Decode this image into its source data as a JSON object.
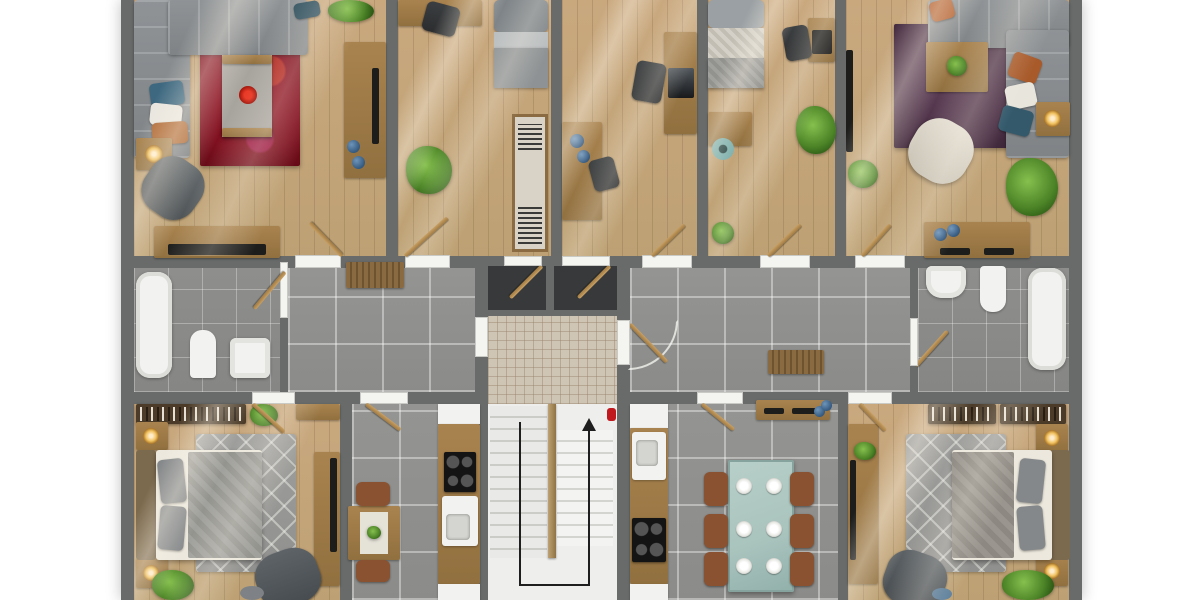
{
  "meta": {
    "title": "Apartment floor plan — top-down 3D render",
    "view": "top-down",
    "no_visible_text": true
  },
  "palette": {
    "wall": "#686b6a",
    "wood": "#c9a87e",
    "woodfurn": "#a9834f",
    "tile": "#949492",
    "bath": "#8e8e8c",
    "mosaic": "#cec5b5",
    "rugred": "#7d0f1e",
    "rugpurple": "#4a2f44",
    "ruggray": "#9e9e9c",
    "plant": "#4c8427",
    "accentblue": "#35597f",
    "tableteal": "#a9c3bd",
    "chairbrown": "#8a5230",
    "extinguisher": "#c0181c"
  },
  "rooms": [
    {
      "id": "living-left",
      "label": "Living room (top left)",
      "floor": "wood",
      "furniture": [
        "corner sofa",
        "red area rug",
        "coffee table with flowers",
        "armchair",
        "side table with lamp",
        "media console",
        "sideboard",
        "plants",
        "pillows"
      ]
    },
    {
      "id": "study",
      "label": "Study (top)",
      "floor": "wood",
      "furniture": [
        "desk",
        "office chair",
        "daybed",
        "open wardrobe",
        "plant"
      ]
    },
    {
      "id": "office-center",
      "label": "Office (top center)",
      "floor": "wood",
      "furniture": [
        "wall desk",
        "desk with laptop",
        "2 office chairs",
        "blue decor"
      ]
    },
    {
      "id": "office-right",
      "label": "Office (top right-center)",
      "floor": "wood",
      "furniture": [
        "single bed",
        "side table",
        "teal stool",
        "desk with monitor",
        "office chair",
        "plant"
      ]
    },
    {
      "id": "living-right",
      "label": "Living room (top right)",
      "floor": "wood",
      "furniture": [
        "corner sofa",
        "purple area rug",
        "square coffee table with plant",
        "cream armchair",
        "side table with lamp",
        "TV panel",
        "console",
        "plants",
        "pillows"
      ]
    },
    {
      "id": "bathroom-left",
      "label": "Bathroom (left)",
      "floor": "bath-tile",
      "furniture": [
        "bathtub",
        "toilet",
        "washbasin"
      ]
    },
    {
      "id": "hallway-left",
      "label": "Hallway (left)",
      "floor": "tile",
      "furniture": [
        "bench"
      ]
    },
    {
      "id": "entry-closets",
      "label": "Entry closets",
      "floor": "dark",
      "furniture": [
        "open doors"
      ]
    },
    {
      "id": "stair-landing",
      "label": "Stair landing",
      "floor": "mosaic"
    },
    {
      "id": "staircase",
      "label": "Staircase",
      "flights": 2,
      "direction_arrow": "up",
      "fire_extinguisher": true
    },
    {
      "id": "hallway-right",
      "label": "Hallway (right)",
      "floor": "tile",
      "furniture": [
        "bench"
      ]
    },
    {
      "id": "bathroom-right",
      "label": "Bathroom (right)",
      "floor": "bath-tile",
      "furniture": [
        "washbasin",
        "toilet",
        "bathtub"
      ]
    },
    {
      "id": "bedroom-left",
      "label": "Bedroom (bottom left)",
      "floor": "wood",
      "furniture": [
        "double bed",
        "2 nightstands with lamps",
        "bookshelf",
        "diamond rug",
        "armchair",
        "desk with TV",
        "plants",
        "stool"
      ]
    },
    {
      "id": "kitchen-left",
      "label": "Kitchen (bottom left-center)",
      "floor": "tile",
      "furniture": [
        "4-burner cooktop",
        "sink",
        "upper and lower cabinets",
        "table for two",
        "2 chairs"
      ]
    },
    {
      "id": "kitchen-dining-right",
      "label": "Kitchen / dining (bottom right-center)",
      "floor": "tile",
      "furniture": [
        "fridge",
        "sink",
        "4-burner cooktop",
        "glass dining table",
        "6 chairs",
        "6 place settings",
        "sideboard"
      ]
    },
    {
      "id": "bedroom-right",
      "label": "Bedroom (bottom right)",
      "floor": "wood",
      "furniture": [
        "double bed",
        "2 nightstands with lamps",
        "2 bookshelves",
        "diamond rug",
        "armchair",
        "desk with TV",
        "plants",
        "ottoman"
      ]
    }
  ],
  "annotations": {
    "stair_direction": "up",
    "door_count": 15
  }
}
